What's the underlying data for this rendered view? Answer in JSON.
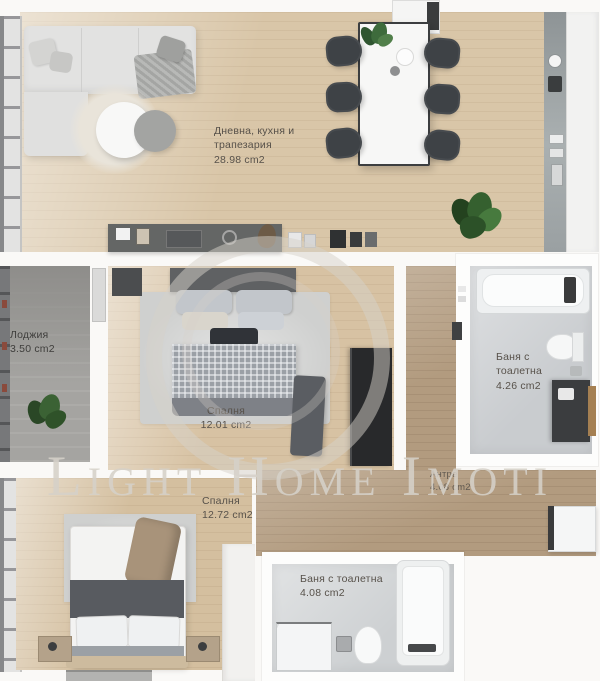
{
  "watermark": {
    "text": "Light Home Imoti"
  },
  "rooms": {
    "living": {
      "name": "Дневна, кухня и трапезария",
      "area": "28.98 cm2"
    },
    "loggia": {
      "name": "Лоджия",
      "area": "3.50 cm2"
    },
    "bedroom1": {
      "name": "Спалня",
      "area": "12.01 cm2"
    },
    "bedroom2": {
      "name": "Спалня",
      "area": "12.72 cm2"
    },
    "bath_top": {
      "name": "Баня с тоалетна",
      "area": "4.26 cm2"
    },
    "bath_bottom": {
      "name": "Баня с тоалетна",
      "area": "4.08 cm2"
    },
    "hallway": {
      "name": "Антре",
      "area": "4.08 cm2"
    }
  },
  "palette": {
    "wood_floor": "#d9c6a8",
    "wood_floor_dark": "#b29b7f",
    "tile_floor": "#c9cccf",
    "loggia_floor": "#a5a4a1",
    "furniture_dark": "#3e4246",
    "plant_green": "#3c643a",
    "label_text": "#57514a",
    "watermark_gray": "#d5d0c8"
  }
}
